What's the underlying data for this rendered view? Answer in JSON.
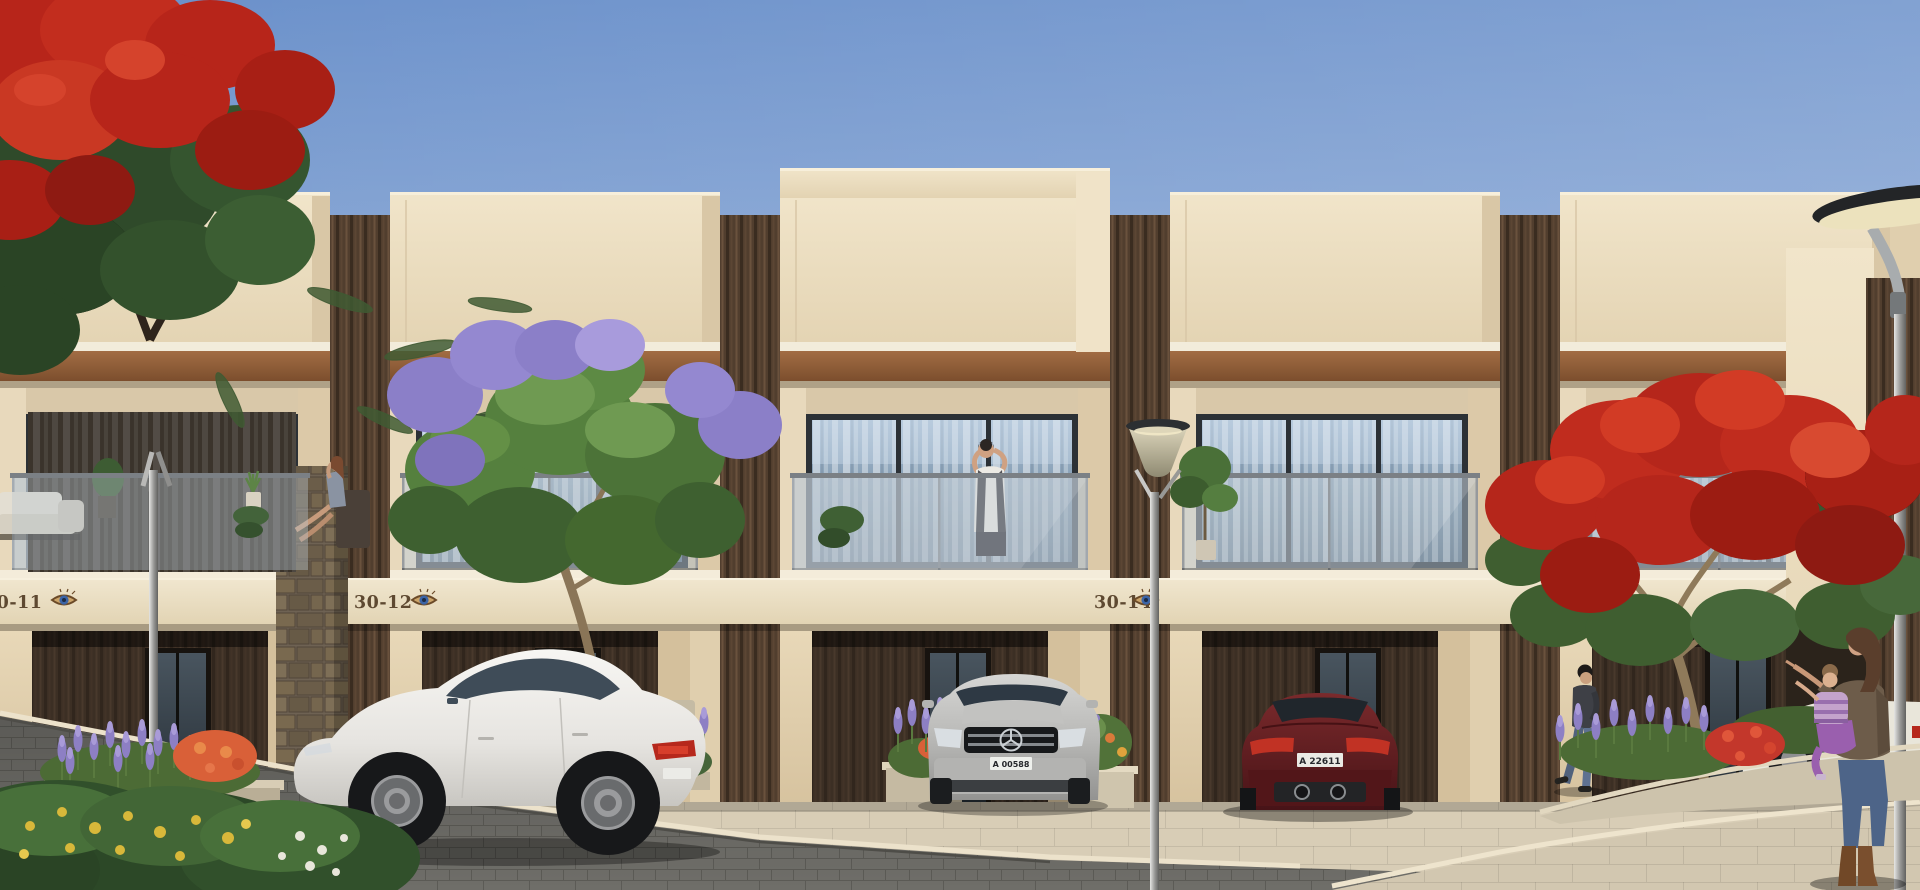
{
  "building": {
    "plaques": [
      "30-11",
      "30-12",
      "30-14"
    ],
    "plaque_logo": "eye-logo"
  },
  "vehicles": {
    "suv_plate": "A 00588",
    "red_coupe_plate": "A 22611"
  },
  "palette": {
    "sky_top": "#6a90ca",
    "sky_horizon": "#c9d7ec",
    "wall_cream": "#eadcbe",
    "wall_band": "#f0e6ce",
    "wood_slats": "#503d2d",
    "awning_rust": "#8a5a38",
    "window_glass": "#7e97ad",
    "street_asphalt": "#6d6c67",
    "sidewalk_stone": "#d8cdb6",
    "poinciana_red": "#b5261b",
    "jacaranda_green": "#55803e",
    "bloom_purple": "#8b7fc8",
    "lavender_purple": "#8d7fc4",
    "car_white": "#f2f1ee",
    "car_silver": "#b9b9b7",
    "car_maroon": "#5e1d20"
  }
}
